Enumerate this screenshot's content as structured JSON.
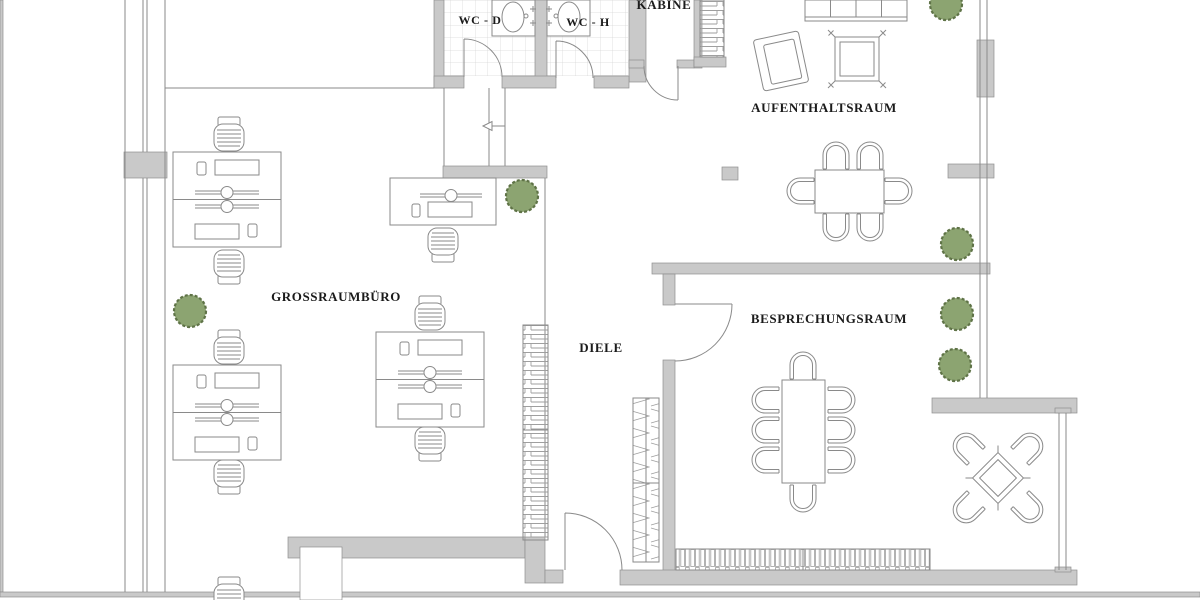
{
  "document": {
    "type": "architectural-floor-plan",
    "language": "de"
  },
  "colors": {
    "bg": "#ffffff",
    "wall": "#c9c9c9",
    "wallstroke": "#8f8f8f",
    "line": "#8a8a8a",
    "tile": "#d8d8d8",
    "plantfill": "#8ca471",
    "plantstroke": "#5f7347",
    "label": "#1b1b1b"
  },
  "labels": {
    "wc_d": "WC - D",
    "wc_h": "WC - H",
    "kabine": "KABINE",
    "aufenthaltsraum": "AUFENTHALTSRAUM",
    "grossraumbuero": "GROSSRAUMBÜRO",
    "diele": "DIELE",
    "besprechungsraum": "BESPRECHUNGSRAUM"
  },
  "icons": [
    "wall",
    "window-glazing",
    "door-swing",
    "tile-floor",
    "sink-basin",
    "stairs-strip",
    "shelf-strip",
    "wardrobe-strip",
    "radiator",
    "desk-pair",
    "single-desk",
    "office-chair",
    "visitor-chair",
    "dining-table",
    "conference-table",
    "sofa",
    "armchair",
    "coffee-table",
    "lounge-table",
    "plant"
  ],
  "counts": {
    "plants": 6,
    "desk_pairs": 3,
    "single_desks": 1,
    "office_chairs": 8,
    "dining_chairs": 6,
    "conference_chairs": 8,
    "lounge_chairs": 4
  }
}
